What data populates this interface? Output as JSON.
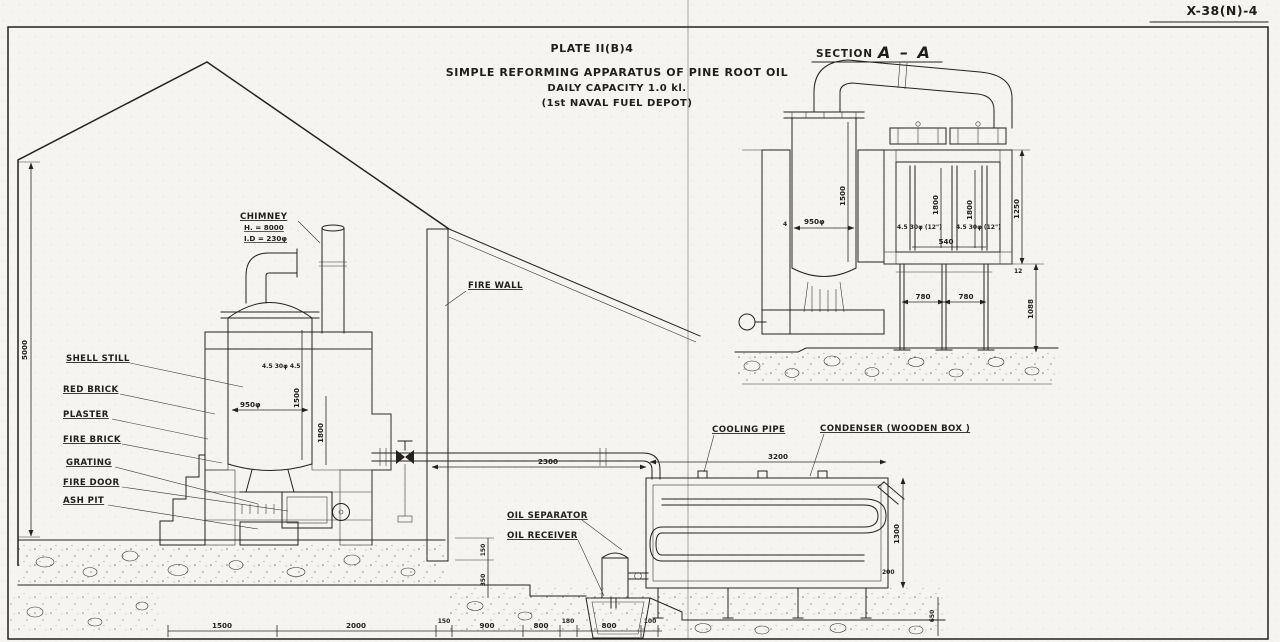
{
  "sheet": {
    "doc_number": "X-38(N)-4",
    "plate": "PLATE II(B)4",
    "title": "SIMPLE REFORMING APPARATUS OF PINE ROOT OIL",
    "subtitle": "DAILY CAPACITY 1.0 kl.",
    "issuer": "(1st NAVAL FUEL DEPOT)",
    "section_label": "SECTION",
    "section_name": "A – A"
  },
  "labels": {
    "chimney": "CHIMNEY",
    "chimney_height": "H. = 8000",
    "chimney_id": "I.D = 230φ",
    "fire_wall": "FIRE WALL",
    "shell_still": "SHELL STILL",
    "red_brick": "RED BRICK",
    "plaster": "PLASTER",
    "fire_brick": "FIRE BRICK",
    "grating": "GRATING",
    "fire_door": "FIRE DOOR",
    "ash_pit": "ASH PIT",
    "cooling_pipe": "COOLING PIPE",
    "condenser": "CONDENSER (WOODEN BOX )",
    "oil_separator": "OIL SEPARATOR",
    "oil_receiver": "OIL RECEIVER"
  },
  "dims": {
    "elevation": {
      "wall_height": "5000",
      "still_shell_note": "4.5 30φ 4.5",
      "still_dia": "950φ",
      "still_height": "1500",
      "firebox_height": "1800",
      "cooling_pipe_run": "2300",
      "condenser_length": "3200",
      "condenser_height": "1300",
      "condenser_sill": "200",
      "foundation_depth": "650",
      "pit_step": "150",
      "pit_depth": "350",
      "bottom_row": [
        "1500",
        "2000",
        "150",
        "900",
        "800",
        "180",
        "800",
        "100"
      ]
    },
    "section": {
      "still_dia": "950φ",
      "still_height": "1500",
      "wall_note": "4",
      "tube_height_left": "1800",
      "tube_height_right": "1800",
      "tube_note_left": "4.5 30φ (12\")",
      "tube_note_right": "4.5 30φ (12\")",
      "tube_spacing": "540",
      "box_height": "1250",
      "leg_height": "1088",
      "plank": "12",
      "leg_span_left": "780",
      "leg_span_right": "780"
    }
  }
}
